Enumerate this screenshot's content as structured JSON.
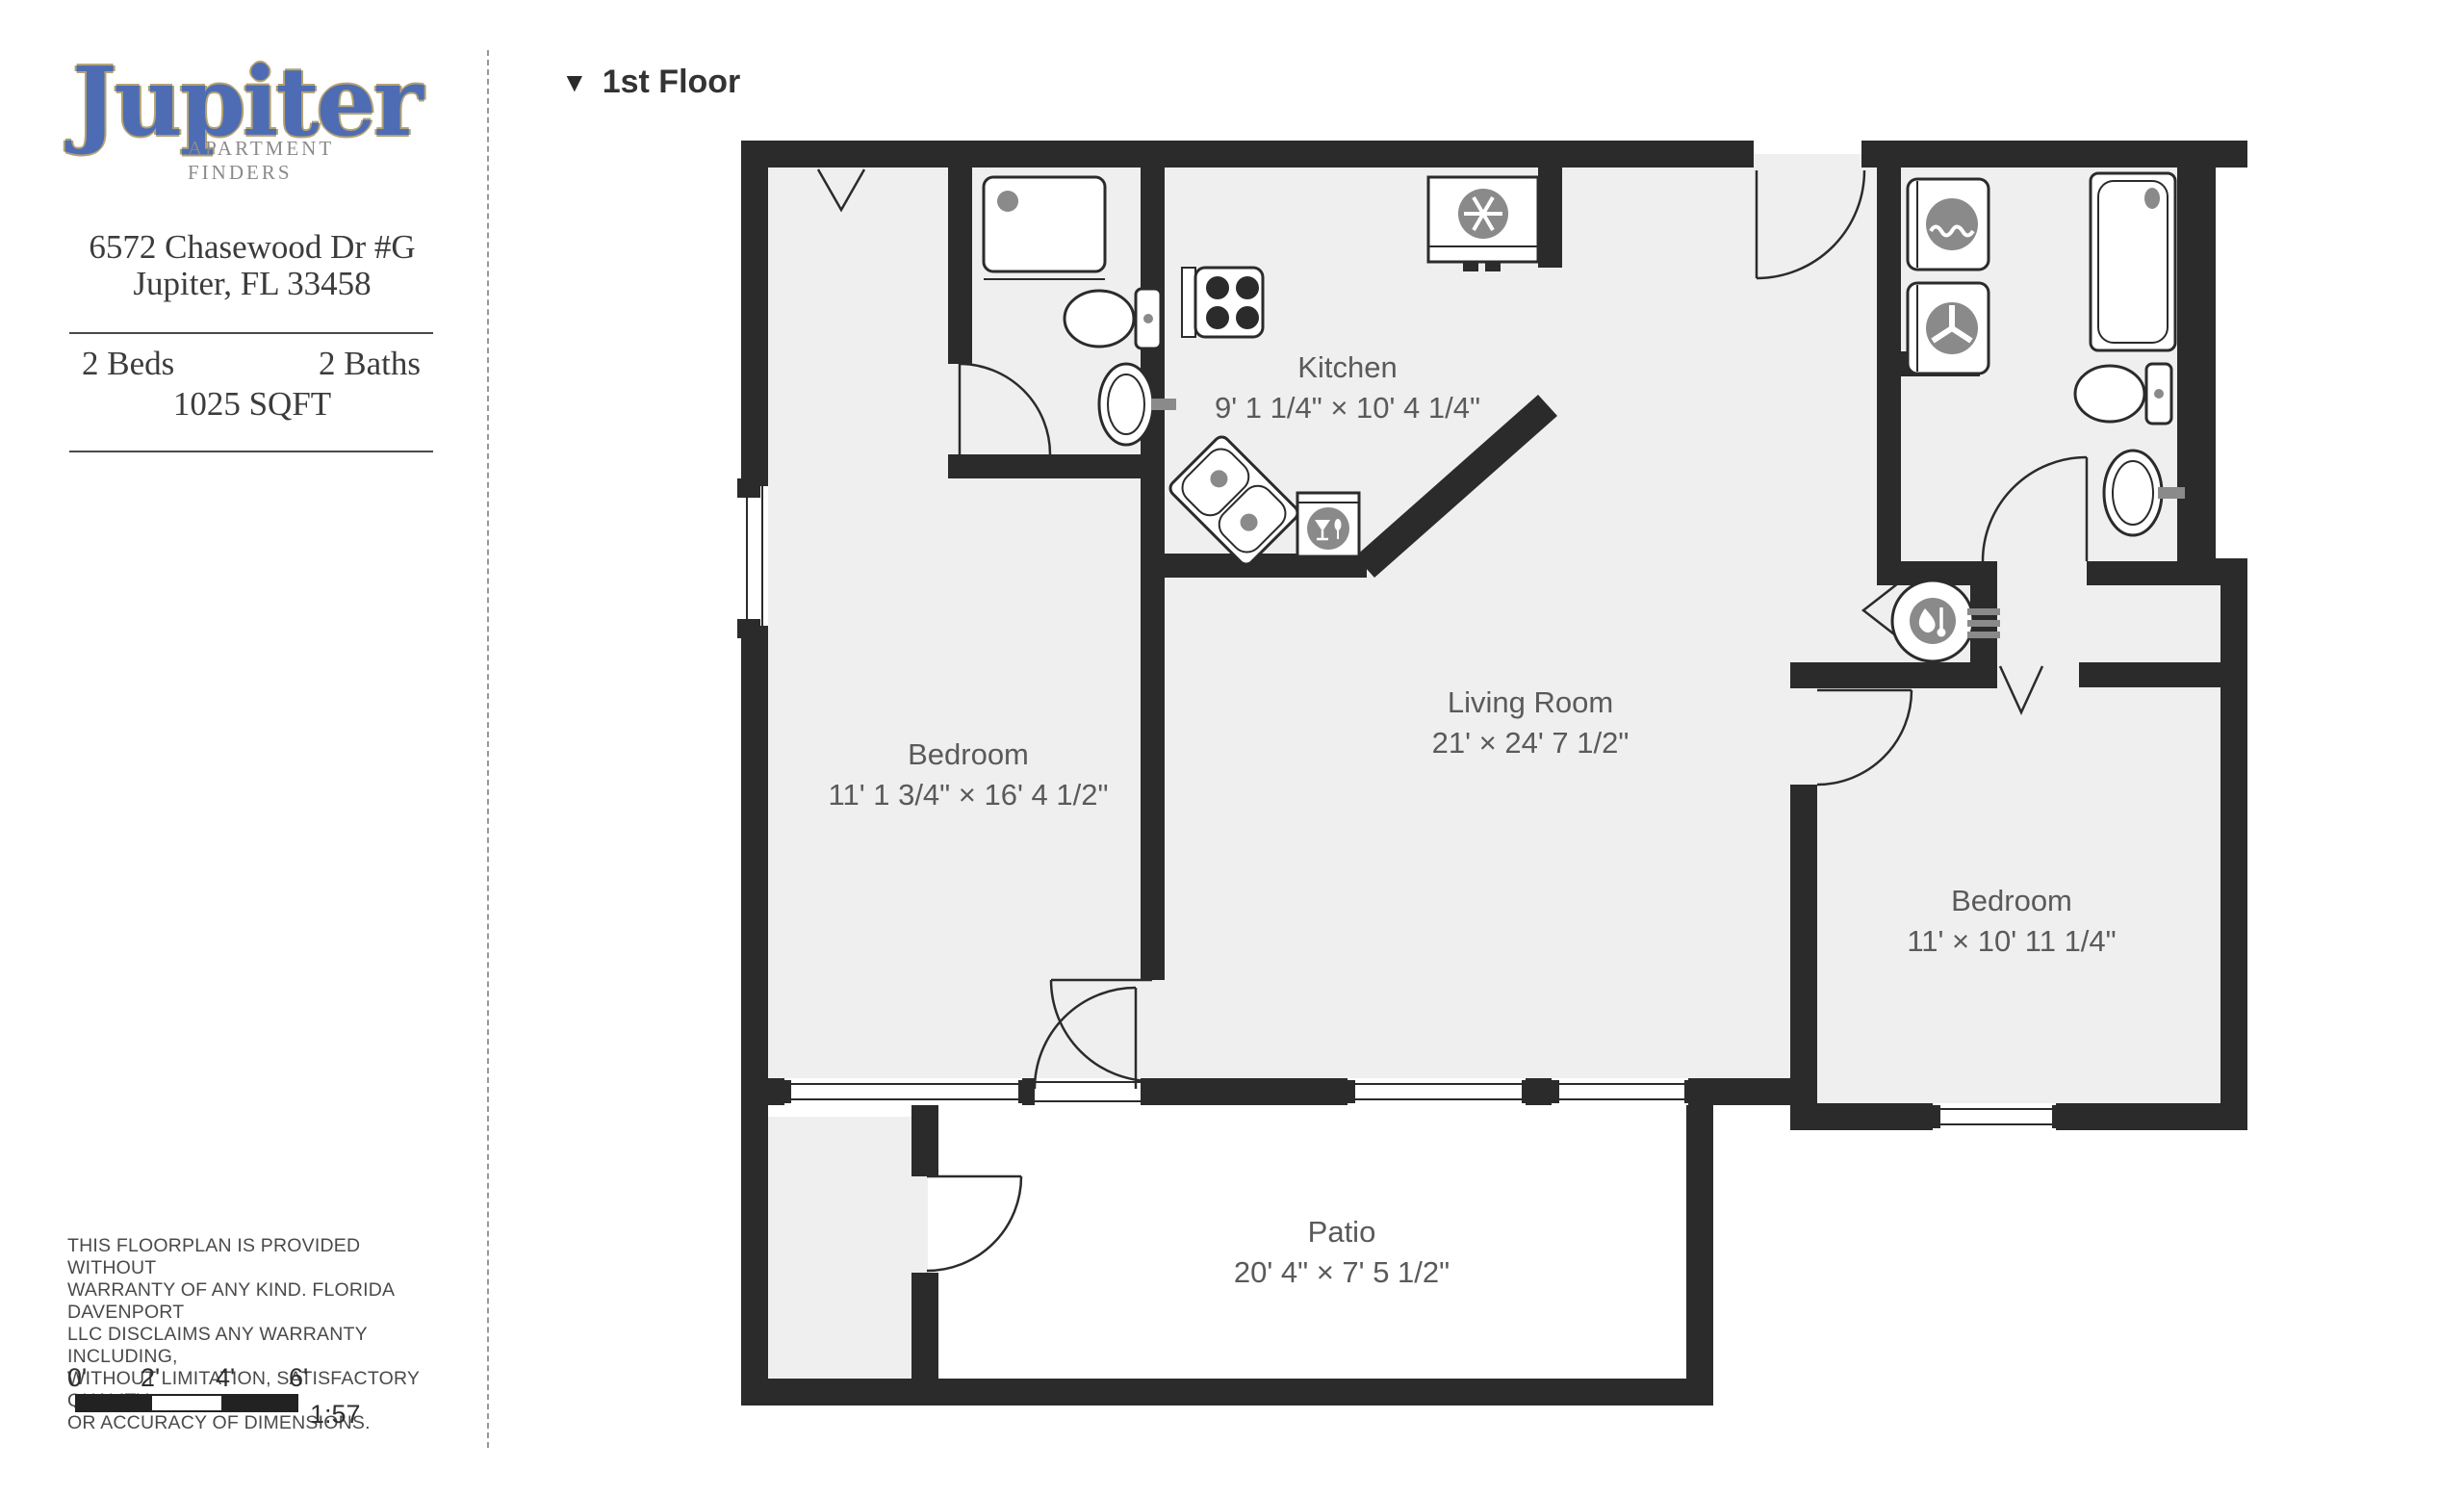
{
  "branding": {
    "logo_text": "Jupiter",
    "logo_subtext": "APARTMENT FINDERS"
  },
  "listing": {
    "address_line1": "6572 Chasewood Dr #G",
    "address_line2": "Jupiter, FL 33458",
    "beds": "2 Beds",
    "baths": "2 Baths",
    "sqft": "1025 SQFT"
  },
  "floor": {
    "marker": "▼",
    "label": "1st Floor"
  },
  "rooms": {
    "kitchen": {
      "name": "Kitchen",
      "dims": "9' 1 1/4\" × 10' 4 1/4\""
    },
    "living": {
      "name": "Living Room",
      "dims": "21' × 24' 7 1/2\""
    },
    "bedroom1": {
      "name": "Bedroom",
      "dims": "11' 1 3/4\" × 16' 4 1/2\""
    },
    "bedroom2": {
      "name": "Bedroom",
      "dims": "11' × 10' 11 1/4\""
    },
    "patio": {
      "name": "Patio",
      "dims": "20' 4\" × 7' 5 1/2\""
    }
  },
  "disclaimer": {
    "lines": [
      "THIS FLOORPLAN IS PROVIDED WITHOUT",
      "WARRANTY OF ANY KIND. FLORIDA DAVENPORT",
      "LLC DISCLAIMS ANY WARRANTY INCLUDING,",
      "WITHOUT LIMITATION, SATISFACTORY QUALITY",
      "OR ACCURACY OF DIMENSIONS."
    ]
  },
  "scalebar": {
    "labels": [
      "0'",
      "2'",
      "4'",
      "6'"
    ],
    "ratio": "1:57"
  },
  "colors": {
    "wall": "#2b2b2b",
    "room_fill": "#efefef",
    "fixture_gray": "#8a8a8a",
    "logo_blue": "#4d6cb3",
    "logo_outline": "#b3a272",
    "label_text": "#5a5a5a"
  }
}
